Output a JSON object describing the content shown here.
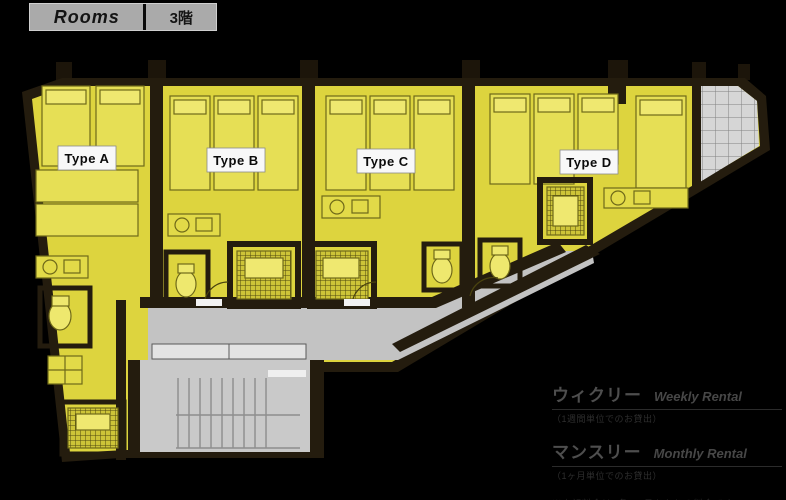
{
  "header": {
    "title": "Rooms",
    "floor": "3階"
  },
  "floorplan": {
    "units": [
      {
        "id": "A",
        "label": "Type A"
      },
      {
        "id": "B",
        "label": "Type B"
      },
      {
        "id": "C",
        "label": "Type C"
      },
      {
        "id": "D",
        "label": "Type D"
      }
    ]
  },
  "legend": {
    "weekly": {
      "jp": "ウィクリー",
      "en": "Weekly Rental",
      "note": "（1週間単位でのお貸出）"
    },
    "monthly": {
      "jp": "マンスリー",
      "en": "Monthly Rental",
      "note": "（1ヶ月単位でのお貸出）"
    },
    "footnote": "※上記料金は1名1ヶ月あたりの料金です"
  },
  "colors": {
    "background": "#000000",
    "room_yellow": "#ddd43e",
    "wall_dark": "#241c0e",
    "corridor_gray": "#c3c3c3",
    "balcony_gray": "#d6d6d6",
    "label_bg": "#f8f8f8"
  }
}
